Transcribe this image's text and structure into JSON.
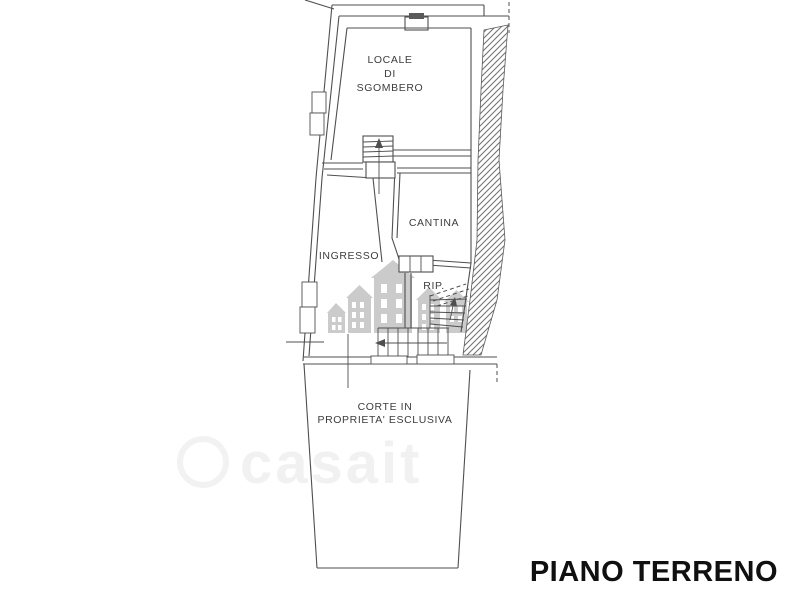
{
  "plan": {
    "floor_title": "PIANO TERRENO",
    "rooms": {
      "locale": {
        "line1": "LOCALE",
        "line2": "DI",
        "line3": "SGOMBERO"
      },
      "cantina": {
        "label": "CANTINA"
      },
      "ingresso": {
        "label": "INGRESSO"
      },
      "rip": {
        "label": "RIP."
      },
      "corte": {
        "line1": "CORTE IN",
        "line2": "PROPRIETA' ESCLUSIVA"
      }
    }
  },
  "watermark": {
    "logo_text": "casait",
    "logo_icon": "casa-it-houses-logo"
  },
  "colors": {
    "background": "#ffffff",
    "line": "#4f4f4f",
    "label_text": "#3d3d3d",
    "title_text": "#101010",
    "hatch_line": "#757575",
    "watermark_houses": "#c7c7c7",
    "watermark_faint": "#ededed"
  }
}
